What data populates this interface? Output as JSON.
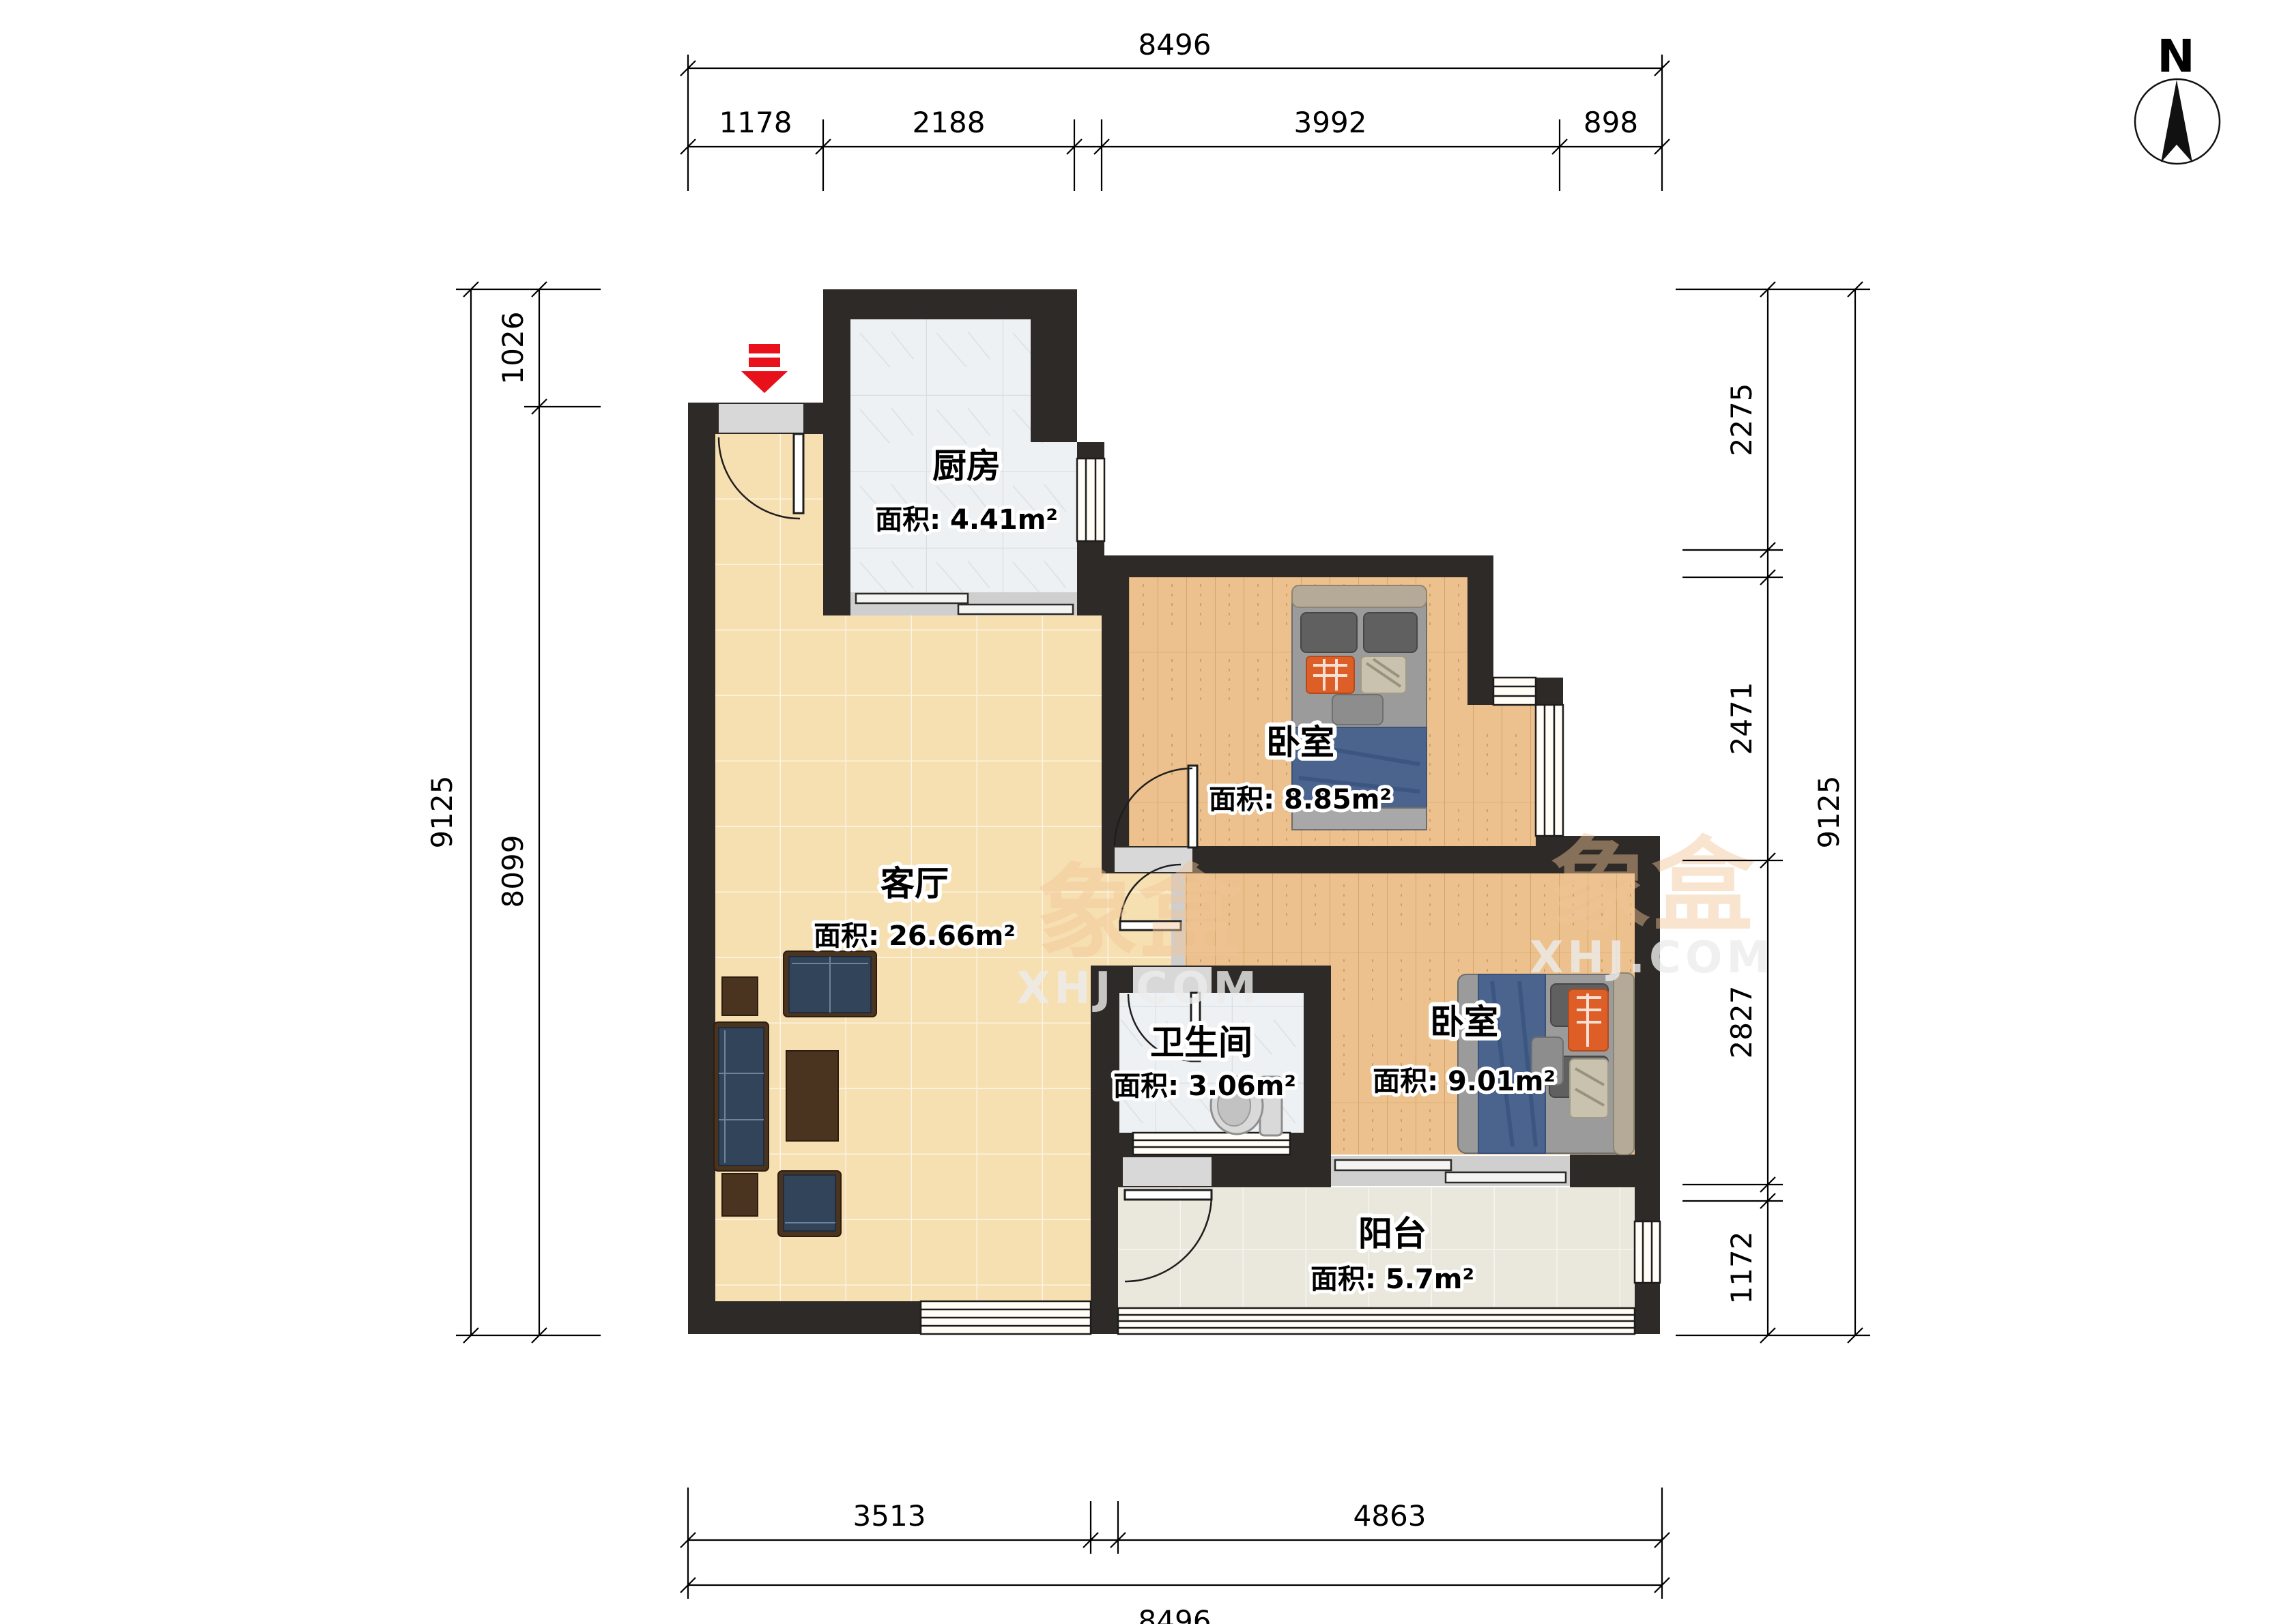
{
  "compass": {
    "label": "N"
  },
  "watermark": {
    "brand": "象盒",
    "site": "XHJ.COM"
  },
  "rooms": {
    "kitchen": {
      "name": "厨房",
      "area": "面积: 4.41m²"
    },
    "bedroom1": {
      "name": "卧室",
      "area": "面积: 8.85m²"
    },
    "bedroom2": {
      "name": "卧室",
      "area": "面积: 9.01m²"
    },
    "living": {
      "name": "客厅",
      "area": "面积: 26.66m²"
    },
    "bathroom": {
      "name": "卫生间",
      "area": "面积: 3.06m²"
    },
    "balcony": {
      "name": "阳台",
      "area": "面积: 5.7m²"
    }
  },
  "dimensions": {
    "top": {
      "total": "8496",
      "segments": [
        "1178",
        "2188",
        "3992",
        "898"
      ]
    },
    "bottom": {
      "total": "8496",
      "segments": [
        "3513",
        "4863"
      ]
    },
    "left": {
      "total": "9125",
      "segments": [
        "1026",
        "8099"
      ]
    },
    "right": {
      "total": "9125",
      "segments": [
        "2275",
        "2471",
        "2827",
        "1172"
      ]
    }
  },
  "colors": {
    "wall": "#2e2a27",
    "living_floor": "#f6dfb1",
    "wood_floor": "#ecc18d",
    "tile_floor": "#eef1f3",
    "balcony_floor": "#eae8dd",
    "sofa": "#324459",
    "wood_furniture": "#4b341f",
    "bed_blanket": "#4b648e",
    "accent_pillow": "#dd5f27",
    "entrance_arrow": "#e8101a"
  }
}
